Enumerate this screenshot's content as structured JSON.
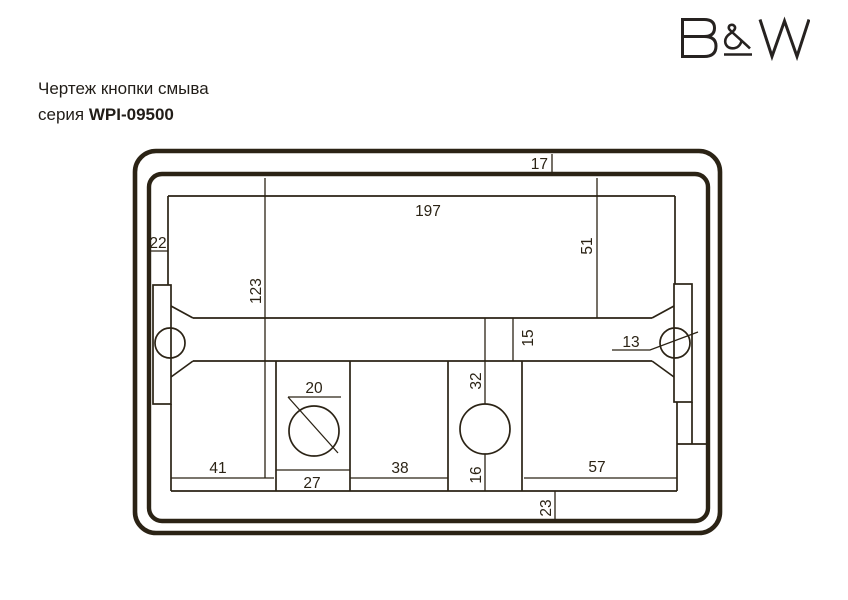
{
  "logo": {
    "text": "B&W"
  },
  "header": {
    "title": "Чертеж кнопки смыва",
    "series_prefix": "серия ",
    "series_code": "WPI-09500"
  },
  "drawing": {
    "colors": {
      "ink": "#2b2315"
    },
    "dims": {
      "top_frame_offset": "17",
      "plate_width": "197",
      "left_frame_offset": "22",
      "right_top_height": "51",
      "left_height": "123",
      "crossbar_height": "15",
      "screw_hole_diameter": "13",
      "button_hole_diameter": "20",
      "above_button": "32",
      "below_button": "16",
      "bottom_left_width": "41",
      "button_column_width": "27",
      "bottom_middle_width": "38",
      "bottom_right_width": "57",
      "bottom_frame_offset": "23"
    }
  }
}
